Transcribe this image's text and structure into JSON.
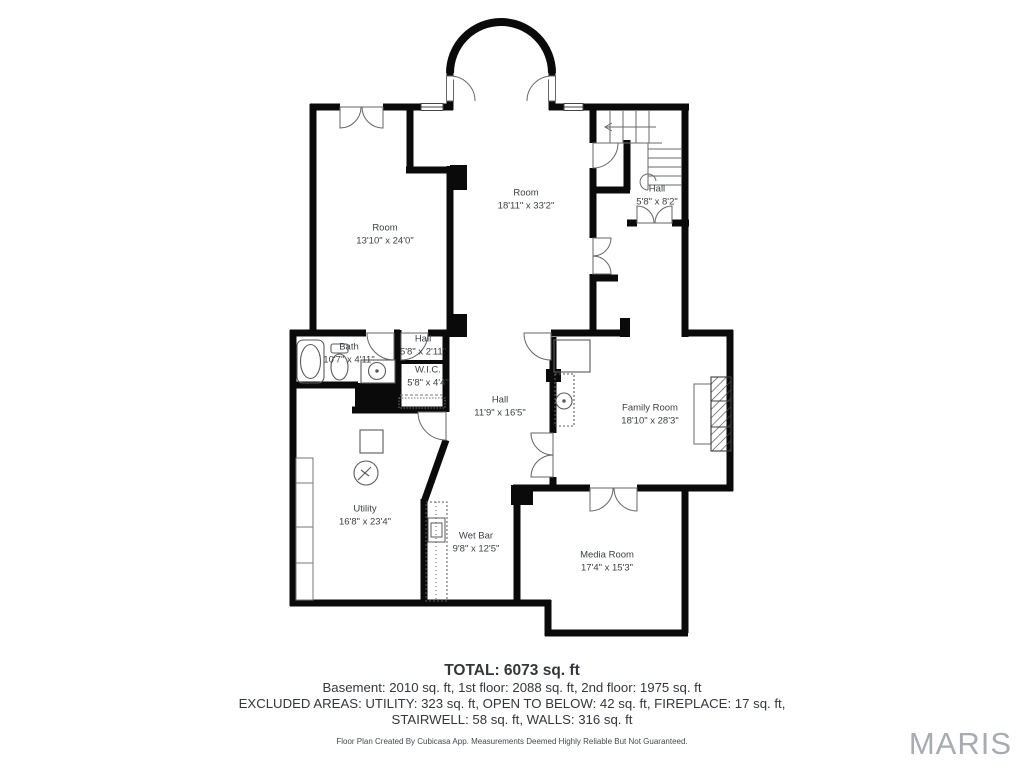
{
  "rooms": [
    {
      "name": "Room",
      "dims": "13'10\" x 24'0\""
    },
    {
      "name": "Room",
      "dims": "18'11\" x 33'2\""
    },
    {
      "name": "Hall",
      "dims": "5'8\" x 8'2\""
    },
    {
      "name": "Bath",
      "dims": "10'7\" x 4'11\""
    },
    {
      "name": "Hall",
      "dims": "5'8\" x 2'11\""
    },
    {
      "name": "W.I.C.",
      "dims": "5'8\" x 4'4\""
    },
    {
      "name": "Hall",
      "dims": "11'9\" x 16'5\""
    },
    {
      "name": "Family Room",
      "dims": "18'10\" x 28'3\""
    },
    {
      "name": "Utility",
      "dims": "16'8\" x 23'4\""
    },
    {
      "name": "Wet Bar",
      "dims": "9'8\" x 12'5\""
    },
    {
      "name": "Media Room",
      "dims": "17'4\" x 15'3\""
    }
  ],
  "footer": {
    "total": "TOTAL: 6073 sq. ft",
    "floors": "Basement: 2010 sq. ft, 1st floor: 2088 sq. ft, 2nd floor: 1975 sq. ft",
    "excluded_line1": "EXCLUDED AREAS: UTILITY: 323 sq. ft, OPEN TO BELOW: 42 sq. ft, FIREPLACE: 17 sq. ft,",
    "excluded_line2": "STAIRWELL: 58 sq. ft, WALLS: 316 sq. ft",
    "disclaimer": "Floor Plan Created By Cubicasa App. Measurements Deemed Highly Reliable But Not Guaranteed."
  },
  "logo": {
    "text": "MARIS"
  },
  "colors": {
    "wall": "#0a0a0a",
    "text": "#3b3f43",
    "logo": "#a7acb2"
  }
}
